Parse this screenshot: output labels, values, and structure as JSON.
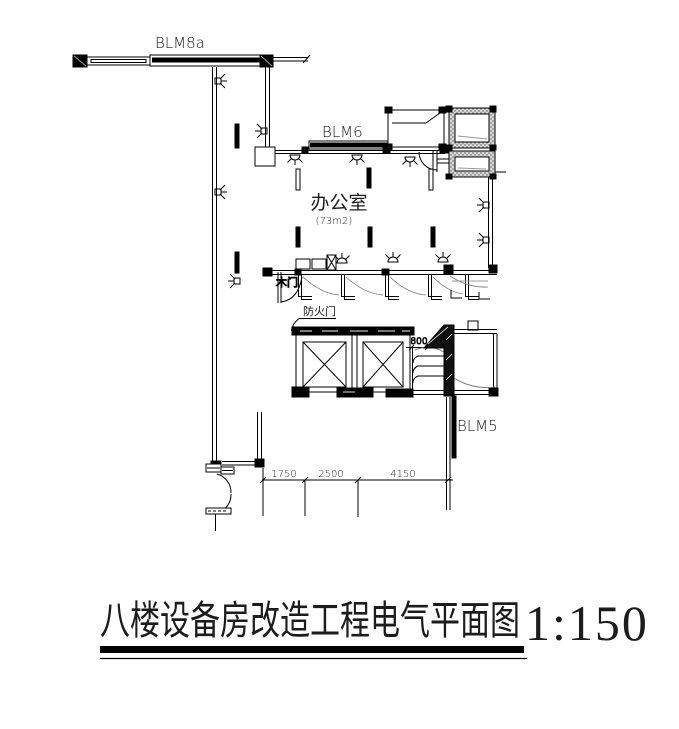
{
  "drawing": {
    "labels": {
      "blm8a": "BLM8a",
      "blm6": "BLM6",
      "blm5": "BLM5",
      "room_name": "办公室",
      "room_area": "(73m2)",
      "wood_door": "木门",
      "fire_door": "防火门"
    },
    "dimensions": {
      "d800": "800",
      "bottom": [
        "1750",
        "2500",
        "4150"
      ]
    },
    "title": {
      "text": "八楼设备房改造工程电气平面图",
      "scale": "1:150"
    },
    "colors": {
      "line": "#000000",
      "detail_gray": "#888888"
    }
  }
}
